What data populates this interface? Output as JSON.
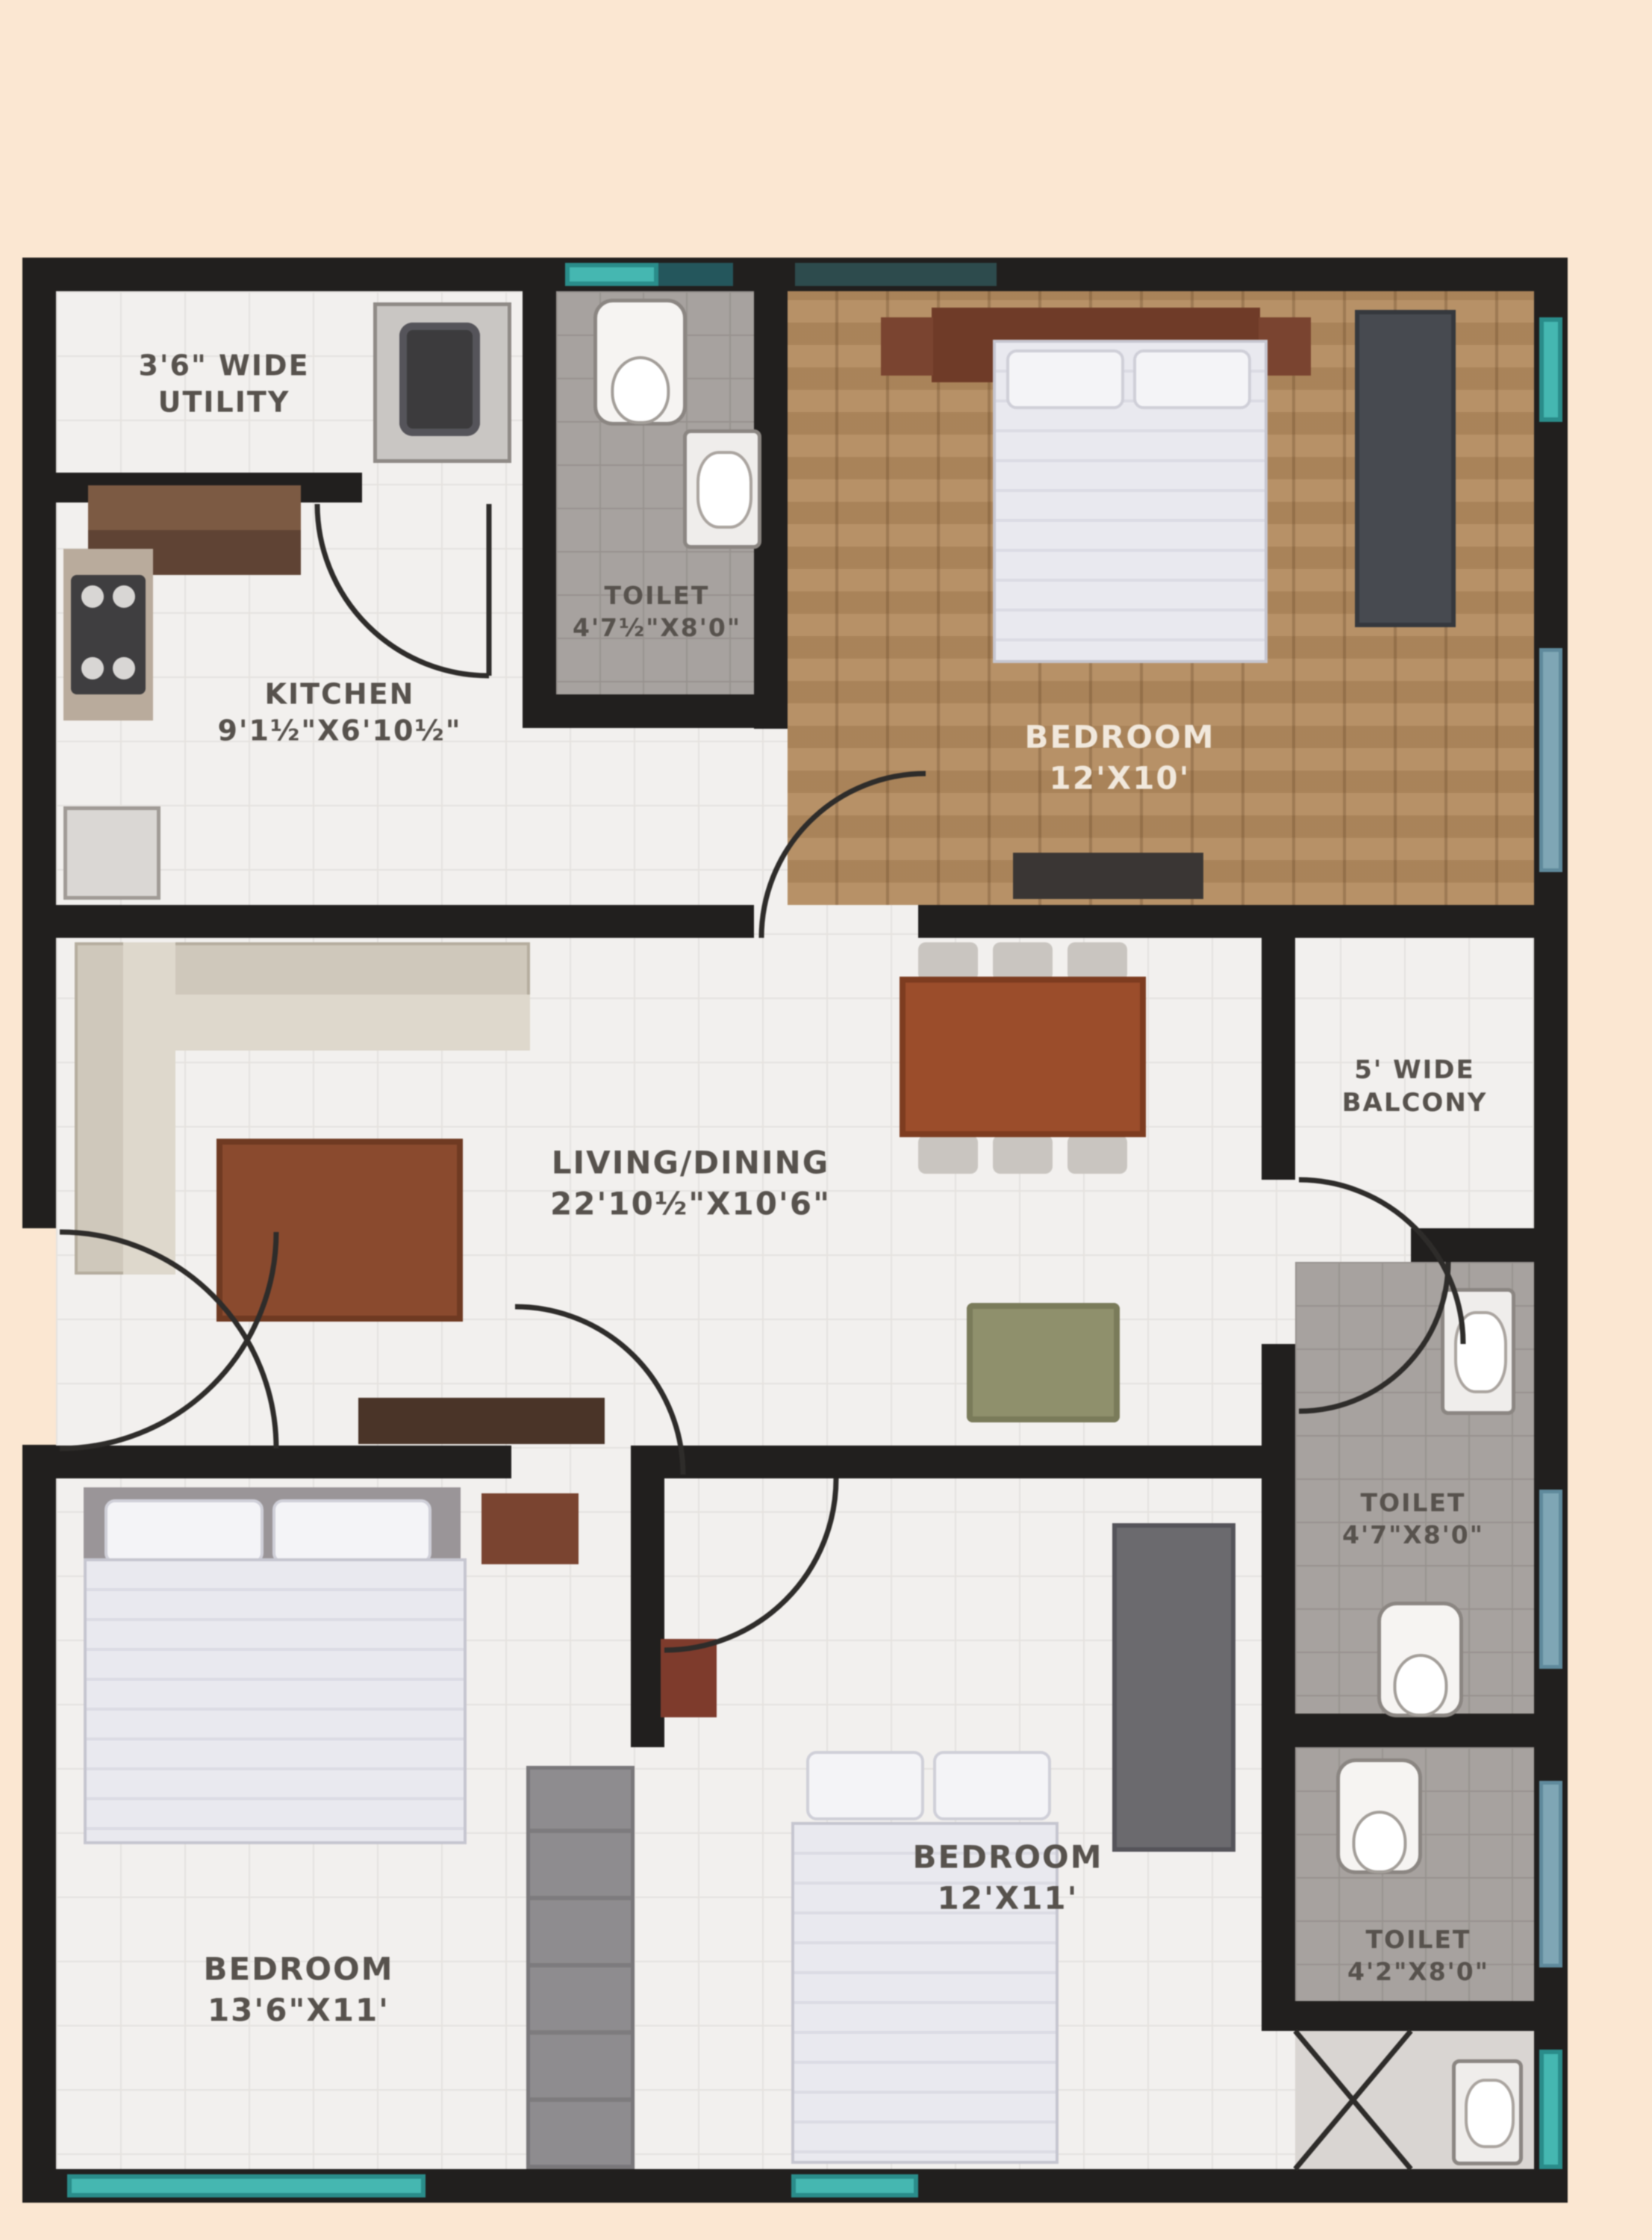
{
  "plan": {
    "title": "apartment-floor-plan",
    "rooms": {
      "utility": {
        "line1": "3'6\" WIDE",
        "line2": "UTILITY"
      },
      "kitchen": {
        "line1": "KITCHEN",
        "line2": "9'1½\"X6'10½\""
      },
      "toilet_top": {
        "line1": "TOILET",
        "line2": "4'7½\"X8'0\""
      },
      "bedroom_top": {
        "line1": "BEDROOM",
        "line2": "12'X10'"
      },
      "living": {
        "line1": "LIVING/DINING",
        "line2": "22'10½\"X10'6\""
      },
      "balcony": {
        "line1": "5' WIDE",
        "line2": "BALCONY"
      },
      "toilet_right": {
        "line1": "TOILET",
        "line2": "4'7\"X8'0\""
      },
      "bedroom_mid": {
        "line1": "BEDROOM",
        "line2": "12'X11'"
      },
      "bedroom_left": {
        "line1": "BEDROOM",
        "line2": "13'6\"X11'"
      },
      "toilet_bottom": {
        "line1": "TOILET",
        "line2": "4'2\"X8'0\""
      }
    },
    "colors": {
      "background": "#fbe7d2",
      "wall": "#211f1e",
      "window_teal": "#45b7b1",
      "window_dark_teal": "#24565c",
      "window_blue": "#7fa6b5",
      "wood_floor": "#b28a5e",
      "tile_grey": "#a7a29f",
      "label_text": "#57524d"
    }
  }
}
